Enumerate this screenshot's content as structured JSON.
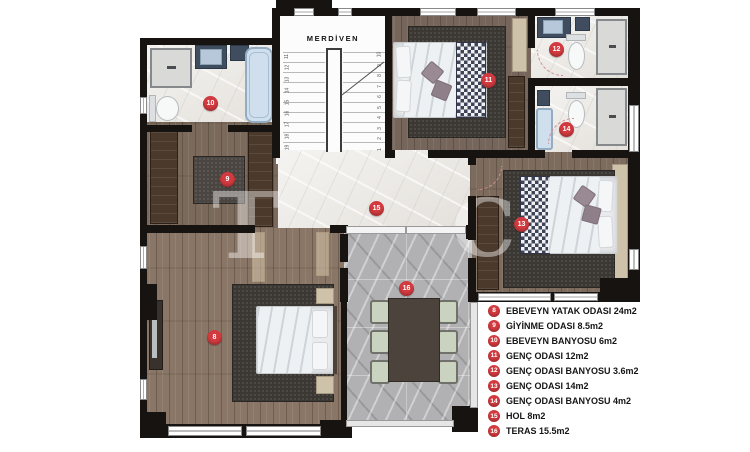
{
  "plan_title": "Floor plan (upper storey)",
  "stairs": {
    "label": "MERDİVEN",
    "left_numbers": [
      "11",
      "12",
      "13",
      "14",
      "15",
      "16",
      "17",
      "18",
      "19"
    ],
    "right_numbers": [
      "10",
      "9",
      "8",
      "7",
      "6",
      "5",
      "4",
      "3",
      "2",
      "1"
    ]
  },
  "badges": {
    "room8": "8",
    "room9": "9",
    "room10": "10",
    "room11": "11",
    "room12": "12",
    "room13": "13",
    "room14": "14",
    "room15": "15",
    "room16": "16"
  },
  "legend": {
    "items": [
      {
        "num": "8",
        "label": "EBEVEYN YATAK ODASI 24m2"
      },
      {
        "num": "9",
        "label": "GİYİNME ODASI 8.5m2"
      },
      {
        "num": "10",
        "label": "EBEVEYN BANYOSU 6m2"
      },
      {
        "num": "11",
        "label": "GENÇ ODASI 12m2"
      },
      {
        "num": "12",
        "label": "GENÇ ODASI BANYOSU 3.6m2"
      },
      {
        "num": "13",
        "label": "GENÇ ODASI 14m2"
      },
      {
        "num": "14",
        "label": "GENÇ ODASI BANYOSU 4m2"
      },
      {
        "num": "15",
        "label": "HOL 8m2"
      },
      {
        "num": "16",
        "label": "TERAS 15.5m2"
      }
    ]
  },
  "watermark": {
    "letter1": "T",
    "letter2": "C"
  },
  "colors": {
    "badge_red": "#d23a3f",
    "wall_black": "#171310"
  }
}
